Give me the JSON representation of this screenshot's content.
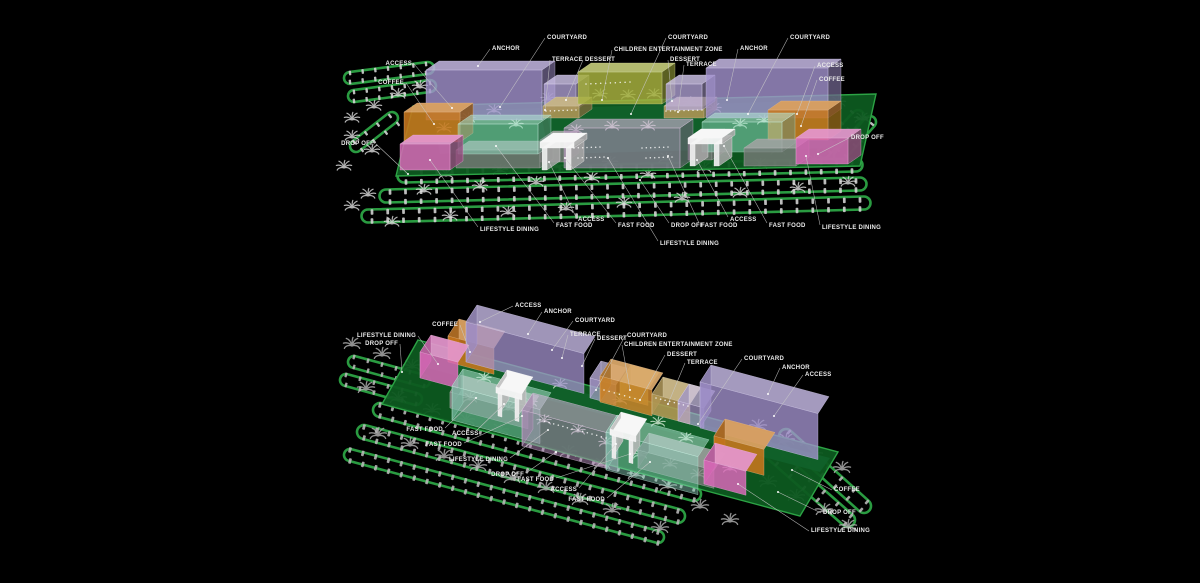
{
  "canvas": {
    "width": 1200,
    "height": 583,
    "background": "#000000"
  },
  "palette": {
    "site_green": "#0d5a20",
    "courtyard_green": "#11622a",
    "road_green": "#2ca345",
    "anchor_purple": "#a493cf",
    "back_lavender": "#b7a8dd",
    "entertainment_olive": "#a6b03e",
    "terrace_tan": "#ad9554",
    "dessert_tan": "#b59a55",
    "coffee_orange": "#c8761c",
    "lifestyle_pink": "#d969b8",
    "dining_mauve": "#bb8fc4",
    "fastfood_teal": "#8fd9c0",
    "roof_grey": "#7c7c7c",
    "access_white": "#ececec",
    "car_grey_upper": "#d6d6d6",
    "car_grey_lower": "#b9b9b9",
    "palm_white": "#dedede",
    "palm_grey": "#b5b5b5",
    "pad_palm": "#d8ecd8",
    "leader_line": "#c9c9c9",
    "label_text": "#eaeaea"
  },
  "views": [
    {
      "id": "upper",
      "labels": [
        {
          "text": "ACCESS",
          "x": 412,
          "y": 63,
          "anchor": "end",
          "lx": 414,
          "ly": 64,
          "px": 452,
          "py": 108
        },
        {
          "text": "COFFEE",
          "x": 404,
          "y": 82,
          "anchor": "end",
          "lx": 406,
          "ly": 83,
          "px": 434,
          "py": 124
        },
        {
          "text": "DROP OFF",
          "x": 374,
          "y": 143,
          "anchor": "end",
          "lx": 376,
          "ly": 144,
          "px": 408,
          "py": 174
        },
        {
          "text": "ANCHOR",
          "x": 492,
          "y": 48,
          "anchor": "start",
          "lx": 490,
          "ly": 49,
          "px": 478,
          "py": 66
        },
        {
          "text": "COURTYARD",
          "x": 547,
          "y": 37,
          "anchor": "start",
          "lx": 545,
          "ly": 38,
          "px": 500,
          "py": 107
        },
        {
          "text": "TERRACE",
          "x": 552,
          "y": 59,
          "anchor": "start",
          "lx": 550,
          "ly": 60,
          "px": 545,
          "py": 110
        },
        {
          "text": "DESSERT",
          "x": 585,
          "y": 59,
          "anchor": "start",
          "lx": 583,
          "ly": 60,
          "px": 566,
          "py": 100
        },
        {
          "text": "CHILDREN ENTERTAINMENT ZONE",
          "x": 614,
          "y": 49,
          "anchor": "start",
          "lx": 612,
          "ly": 50,
          "px": 602,
          "py": 100
        },
        {
          "text": "COURTYARD",
          "x": 668,
          "y": 37,
          "anchor": "start",
          "lx": 666,
          "ly": 38,
          "px": 631,
          "py": 114
        },
        {
          "text": "DESSERT",
          "x": 670,
          "y": 59,
          "anchor": "start",
          "lx": 668,
          "ly": 60,
          "px": 672,
          "py": 101
        },
        {
          "text": "TERRACE",
          "x": 686,
          "y": 64,
          "anchor": "start",
          "lx": 684,
          "ly": 65,
          "px": 678,
          "py": 112
        },
        {
          "text": "ANCHOR",
          "x": 740,
          "y": 48,
          "anchor": "start",
          "lx": 738,
          "ly": 49,
          "px": 727,
          "py": 100
        },
        {
          "text": "COURTYARD",
          "x": 790,
          "y": 37,
          "anchor": "start",
          "lx": 788,
          "ly": 38,
          "px": 748,
          "py": 114
        },
        {
          "text": "ACCESS",
          "x": 817,
          "y": 65,
          "anchor": "start",
          "lx": 815,
          "ly": 66,
          "px": 797,
          "py": 114
        },
        {
          "text": "COFFEE",
          "x": 819,
          "y": 79,
          "anchor": "start",
          "lx": 817,
          "ly": 80,
          "px": 801,
          "py": 126
        },
        {
          "text": "DROP OFF",
          "x": 851,
          "y": 137,
          "anchor": "start",
          "lx": 849,
          "ly": 138,
          "px": 818,
          "py": 154
        },
        {
          "text": "LIFESTYLE DINING",
          "x": 480,
          "y": 229,
          "anchor": "start",
          "lx": 478,
          "ly": 227,
          "px": 430,
          "py": 160
        },
        {
          "text": "FAST FOOD",
          "x": 556,
          "y": 225,
          "anchor": "start",
          "lx": 554,
          "ly": 223,
          "px": 496,
          "py": 146
        },
        {
          "text": "ACCESS",
          "x": 578,
          "y": 219,
          "anchor": "start",
          "lx": 576,
          "ly": 217,
          "px": 549,
          "py": 162
        },
        {
          "text": "FAST FOOD",
          "x": 618,
          "y": 225,
          "anchor": "start",
          "lx": 616,
          "ly": 223,
          "px": 565,
          "py": 158
        },
        {
          "text": "DROP OFF",
          "x": 671,
          "y": 225,
          "anchor": "start",
          "lx": 669,
          "ly": 223,
          "px": 640,
          "py": 180
        },
        {
          "text": "LIFESTYLE DINING",
          "x": 660,
          "y": 243,
          "anchor": "start",
          "lx": 658,
          "ly": 241,
          "px": 608,
          "py": 158
        },
        {
          "text": "FAST FOOD",
          "x": 701,
          "y": 225,
          "anchor": "start",
          "lx": 699,
          "ly": 223,
          "px": 668,
          "py": 156
        },
        {
          "text": "ACCESS",
          "x": 730,
          "y": 219,
          "anchor": "start",
          "lx": 728,
          "ly": 217,
          "px": 697,
          "py": 160
        },
        {
          "text": "FAST FOOD",
          "x": 769,
          "y": 225,
          "anchor": "start",
          "lx": 767,
          "ly": 223,
          "px": 724,
          "py": 146
        },
        {
          "text": "LIFESTYLE DINING",
          "x": 822,
          "y": 227,
          "anchor": "start",
          "lx": 820,
          "ly": 225,
          "px": 806,
          "py": 156
        }
      ]
    },
    {
      "id": "lower",
      "labels": [
        {
          "text": "ACCESS",
          "x": 515,
          "y": 305,
          "anchor": "start",
          "lx": 513,
          "ly": 306,
          "px": 480,
          "py": 322
        },
        {
          "text": "ANCHOR",
          "x": 544,
          "y": 311,
          "anchor": "start",
          "lx": 542,
          "ly": 312,
          "px": 528,
          "py": 334
        },
        {
          "text": "COFFEE",
          "x": 458,
          "y": 324,
          "anchor": "end",
          "lx": 460,
          "ly": 325,
          "px": 470,
          "py": 352
        },
        {
          "text": "LIFESTYLE DINING",
          "x": 416,
          "y": 335,
          "anchor": "end",
          "lx": 418,
          "ly": 336,
          "px": 438,
          "py": 364
        },
        {
          "text": "DROP OFF",
          "x": 398,
          "y": 343,
          "anchor": "end",
          "lx": 400,
          "ly": 344,
          "px": 402,
          "py": 372
        },
        {
          "text": "COURTYARD",
          "x": 575,
          "y": 320,
          "anchor": "start",
          "lx": 573,
          "ly": 321,
          "px": 552,
          "py": 350
        },
        {
          "text": "TERRACE",
          "x": 570,
          "y": 334,
          "anchor": "start",
          "lx": 568,
          "ly": 335,
          "px": 562,
          "py": 358
        },
        {
          "text": "DESSERT",
          "x": 597,
          "y": 338,
          "anchor": "start",
          "lx": 595,
          "ly": 339,
          "px": 582,
          "py": 366
        },
        {
          "text": "COURTYARD",
          "x": 627,
          "y": 335,
          "anchor": "start",
          "lx": 625,
          "ly": 336,
          "px": 596,
          "py": 390
        },
        {
          "text": "CHILDREN ENTERTAINMENT ZONE",
          "x": 624,
          "y": 344,
          "anchor": "start",
          "lx": 622,
          "ly": 345,
          "px": 630,
          "py": 390
        },
        {
          "text": "DESSERT",
          "x": 667,
          "y": 354,
          "anchor": "start",
          "lx": 665,
          "ly": 355,
          "px": 640,
          "py": 400
        },
        {
          "text": "TERRACE",
          "x": 687,
          "y": 362,
          "anchor": "start",
          "lx": 685,
          "ly": 363,
          "px": 668,
          "py": 404
        },
        {
          "text": "COURTYARD",
          "x": 744,
          "y": 358,
          "anchor": "start",
          "lx": 742,
          "ly": 359,
          "px": 698,
          "py": 424
        },
        {
          "text": "ANCHOR",
          "x": 782,
          "y": 367,
          "anchor": "start",
          "lx": 780,
          "ly": 368,
          "px": 768,
          "py": 394
        },
        {
          "text": "ACCESS",
          "x": 805,
          "y": 374,
          "anchor": "start",
          "lx": 803,
          "ly": 375,
          "px": 774,
          "py": 416
        },
        {
          "text": "FAST FOOD",
          "x": 443,
          "y": 429,
          "anchor": "end",
          "lx": 445,
          "ly": 428,
          "px": 476,
          "py": 398
        },
        {
          "text": "ACCESS",
          "x": 452,
          "y": 433,
          "anchor": "start",
          "lx": 476,
          "ly": 431,
          "px": 504,
          "py": 404
        },
        {
          "text": "FAST FOOD",
          "x": 462,
          "y": 444,
          "anchor": "end",
          "lx": 464,
          "ly": 443,
          "px": 522,
          "py": 416
        },
        {
          "text": "LIFESTYLE DINING",
          "x": 508,
          "y": 459,
          "anchor": "end",
          "lx": 510,
          "ly": 458,
          "px": 548,
          "py": 430
        },
        {
          "text": "DROP OFF",
          "x": 524,
          "y": 474,
          "anchor": "end",
          "lx": 526,
          "ly": 473,
          "px": 556,
          "py": 452
        },
        {
          "text": "FAST FOOD",
          "x": 554,
          "y": 479,
          "anchor": "end",
          "lx": 556,
          "ly": 478,
          "px": 630,
          "py": 454
        },
        {
          "text": "ACCESS",
          "x": 577,
          "y": 489,
          "anchor": "end",
          "lx": 579,
          "ly": 488,
          "px": 616,
          "py": 444
        },
        {
          "text": "FAST FOOD",
          "x": 605,
          "y": 499,
          "anchor": "end",
          "lx": 607,
          "ly": 498,
          "px": 650,
          "py": 462
        },
        {
          "text": "COFFEE",
          "x": 834,
          "y": 489,
          "anchor": "start",
          "lx": 832,
          "ly": 490,
          "px": 792,
          "py": 470
        },
        {
          "text": "DROP OFF",
          "x": 823,
          "y": 512,
          "anchor": "start",
          "lx": 821,
          "ly": 513,
          "px": 778,
          "py": 492
        },
        {
          "text": "LIFESTYLE DINING",
          "x": 811,
          "y": 530,
          "anchor": "start",
          "lx": 809,
          "ly": 531,
          "px": 738,
          "py": 484
        }
      ]
    }
  ]
}
